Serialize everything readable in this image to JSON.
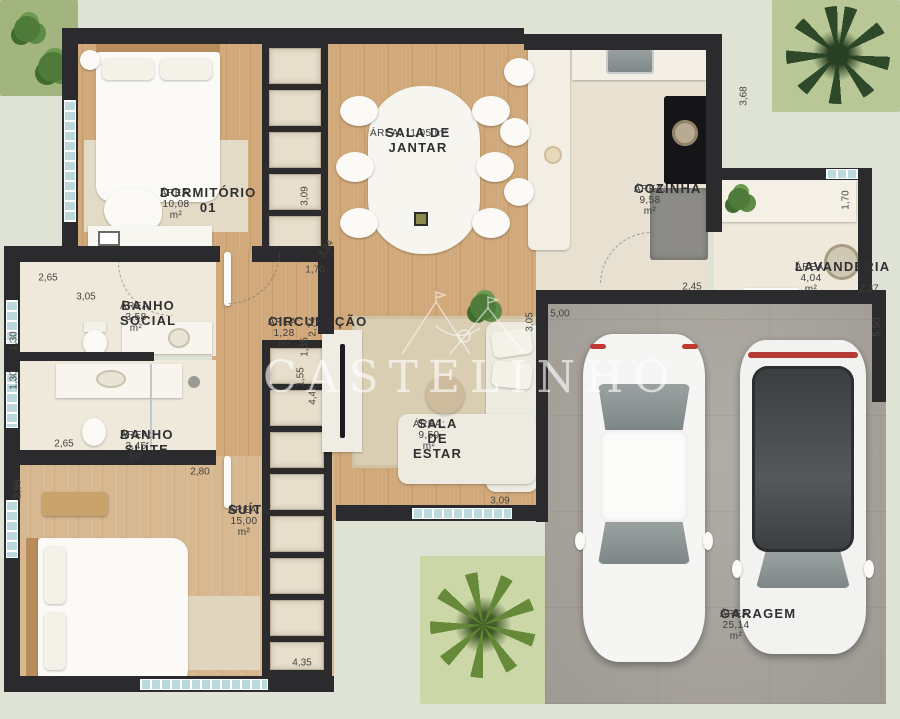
{
  "watermark": {
    "text": "CASTELINHO"
  },
  "rooms": [
    {
      "name": "DORMITÓRIO 01",
      "area": "ÁREA: 10,08 m²"
    },
    {
      "name": "SALA DE JANTAR",
      "area": "ÁREA: 11,05 m²"
    },
    {
      "name": "COZINHA",
      "area": "ÁREA: 9,58 m²"
    },
    {
      "name": "LAVANDERIA",
      "area": "ÁREA: 4,04 m²"
    },
    {
      "name": "BANHO SOCIAL",
      "area": "ÁREA: 3,58 m²"
    },
    {
      "name": "CIRCULAÇÃO",
      "area": "ÁREA: 1,28 m²"
    },
    {
      "name": "BANHO SUÍTE",
      "area": "ÁREA: 3,45 m²"
    },
    {
      "name": "SUÍTE",
      "area": "ÁREA: 15,00 m²"
    },
    {
      "name": "SALA DE ESTAR",
      "area": "ÁREA: 9,59 m²"
    },
    {
      "name": "GARAGEM",
      "area": "ÁREA: 25,14 m²"
    }
  ],
  "dimensions": [
    "3,05",
    "3,09",
    "3,24",
    "1,70",
    "2,65",
    "1,30",
    "1,30",
    "2,65",
    "2,95",
    "2,80",
    "2,74",
    "1,35",
    "1,55",
    "4,40",
    "3,68",
    "1,70",
    "2,45",
    "2,37",
    "5,00",
    "5,50",
    "3,05",
    "3,09",
    "4,35"
  ]
}
